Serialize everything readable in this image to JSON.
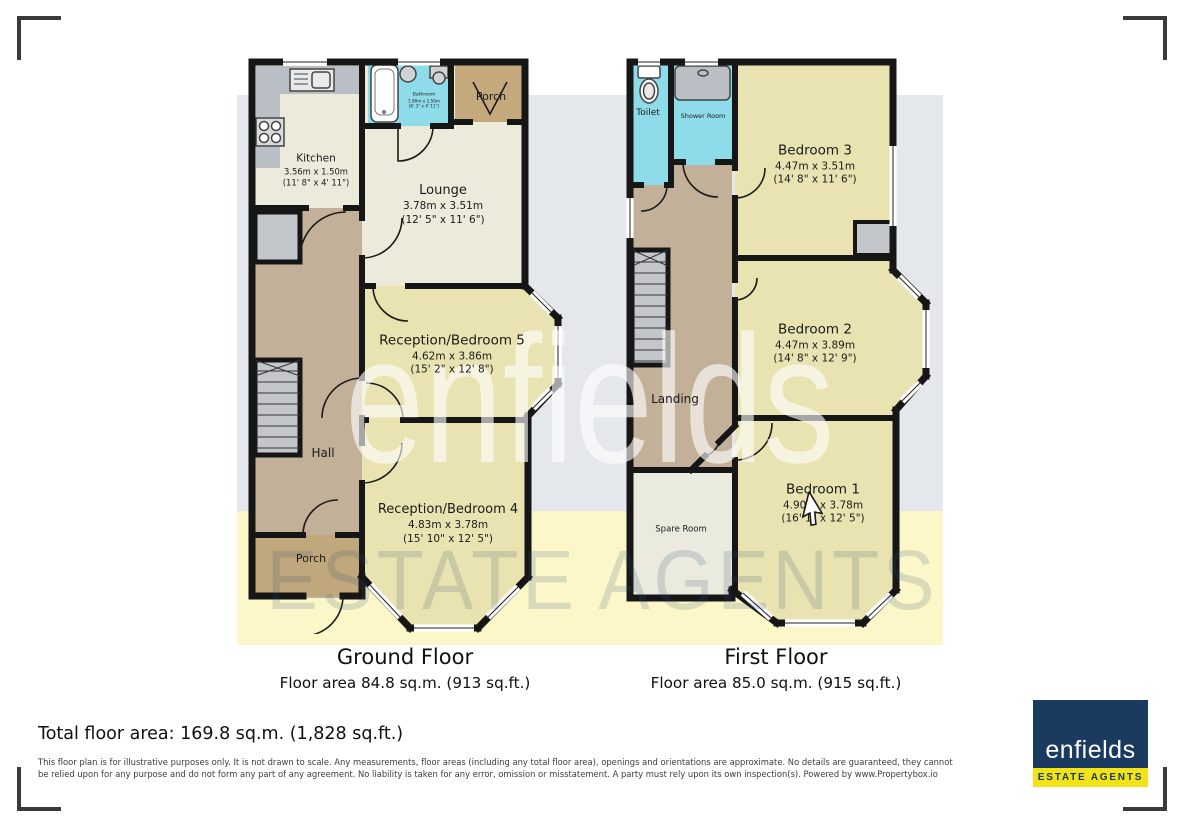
{
  "ground_floor": {
    "caption": "Ground Floor",
    "area_line": "Floor area 84.8 sq.m. (913 sq.ft.)",
    "rooms": {
      "kitchen": {
        "name": "Kitchen",
        "dim_m": "3.56m x 1.50m",
        "dim_ft": "(11' 8\" x 4' 11\")"
      },
      "bathroom": {
        "name": "Bathroom",
        "dim_m": "1.90m x 1.50m",
        "dim_ft": "(6' 3\" x 4' 11\")"
      },
      "porch_top": {
        "name": "Porch"
      },
      "lounge": {
        "name": "Lounge",
        "dim_m": "3.78m x 3.51m",
        "dim_ft": "(12' 5\" x 11' 6\")"
      },
      "reception5": {
        "name": "Reception/Bedroom 5",
        "dim_m": "4.62m x 3.86m",
        "dim_ft": "(15' 2\" x 12' 8\")"
      },
      "hall": {
        "name": "Hall"
      },
      "reception4": {
        "name": "Reception/Bedroom 4",
        "dim_m": "4.83m x 3.78m",
        "dim_ft": "(15' 10\" x 12' 5\")"
      },
      "porch_bottom": {
        "name": "Porch"
      }
    }
  },
  "first_floor": {
    "caption": "First Floor",
    "area_line": "Floor area 85.0 sq.m. (915 sq.ft.)",
    "rooms": {
      "toilet": {
        "name": "Toilet"
      },
      "shower": {
        "name": "Shower Room"
      },
      "bedroom3": {
        "name": "Bedroom 3",
        "dim_m": "4.47m x 3.51m",
        "dim_ft": "(14' 8\" x 11' 6\")"
      },
      "bedroom2": {
        "name": "Bedroom 2",
        "dim_m": "4.47m x 3.89m",
        "dim_ft": "(14' 8\" x 12' 9\")"
      },
      "landing": {
        "name": "Landing"
      },
      "bedroom1": {
        "name": "Bedroom 1",
        "dim_m": "4.90m x 3.78m",
        "dim_ft": "(16' 1\" x 12' 5\")"
      },
      "spare": {
        "name": "Spare Room"
      }
    }
  },
  "watermark": {
    "line1": "enfields",
    "line2": "ESTATE AGENTS"
  },
  "footer": {
    "total_area": "Total floor area: 169.8 sq.m. (1,828 sq.ft.)",
    "disclaimer": "This floor plan is for illustrative purposes only. It is not drawn to scale. Any measurements, floor areas (including any total floor area), openings and orientations are approximate. No details are guaranteed, they cannot be relied upon for any purpose and do not form any part of any agreement. No liability is taken for any error, omission or misstatement. A party must rely upon its own inspection(s). Powered by www.Propertybox.io"
  },
  "logo": {
    "brand": "enfields",
    "tagline": "ESTATE AGENTS"
  },
  "colors": {
    "wall": "#161616",
    "room_cream": "#ecebdb",
    "room_yellow": "#e8e3b0",
    "hall_tan": "#c2b198",
    "porch_tan": "#c6a87d",
    "wet_cyan": "#8edcea",
    "fixture_gray": "#c3c7cb",
    "logo_navy": "#1b3a60",
    "logo_yellow": "#f2e319"
  }
}
